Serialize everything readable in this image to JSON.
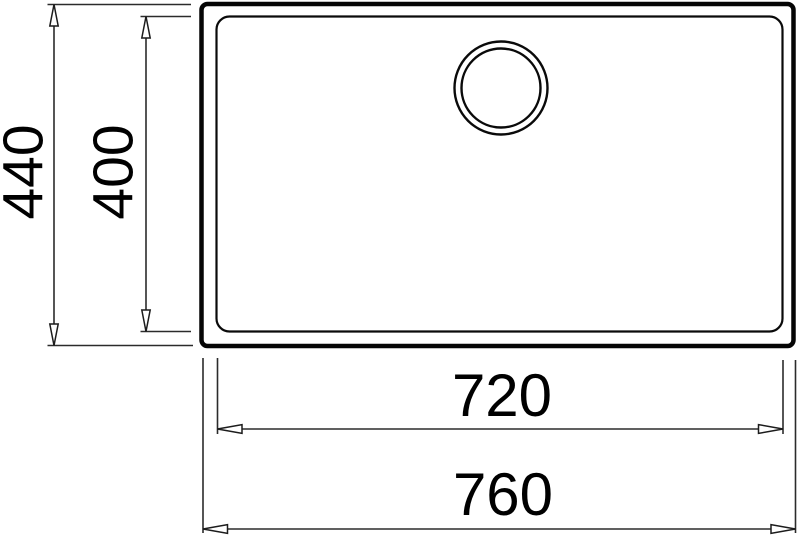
{
  "drawing": {
    "type": "technical-dimension-drawing",
    "subject": "rectangular-sink-bowl-top-view",
    "background": "#ffffff",
    "outline_color": "#000000",
    "dimension_line_color": "#2b2b2b",
    "text_color": "#000000"
  },
  "dimensions": {
    "overall_depth": "440",
    "bowl_depth": "400",
    "bowl_width": "720",
    "overall_width": "760"
  }
}
